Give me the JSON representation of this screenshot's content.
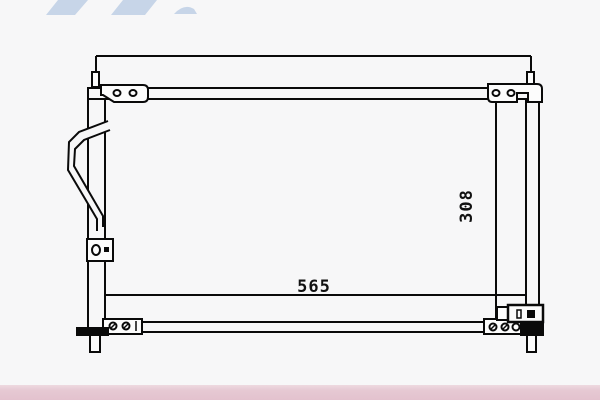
{
  "colors": {
    "background": "#f7f7f8",
    "line": "#0a0a0a",
    "watermark_blue": "#c7d5e8",
    "footer_bar_light": "#eed9e0",
    "footer_bar_pink": "#e3c2ce",
    "fill_light": "#fcfcfc"
  },
  "diagram": {
    "type": "technical-drawing",
    "subject": "condenser-front-view-with-mounting-brackets",
    "dimensions": {
      "width_label": "565",
      "height_label": "308"
    },
    "parts": [
      "top-header-tube",
      "bottom-header-tube",
      "left-tank-tube",
      "right-tube",
      "inlet-hose-loop",
      "mounting-bracket-top-left",
      "mounting-bracket-top-right",
      "mounting-bracket-mid-left",
      "mounting-bracket-bottom-left",
      "mounting-bracket-bottom-right",
      "fitting-block-bottom-right",
      "mounting-pin-top-left",
      "mounting-pin-top-right",
      "mounting-pin-bottom-left",
      "mounting-pin-bottom-right"
    ]
  }
}
